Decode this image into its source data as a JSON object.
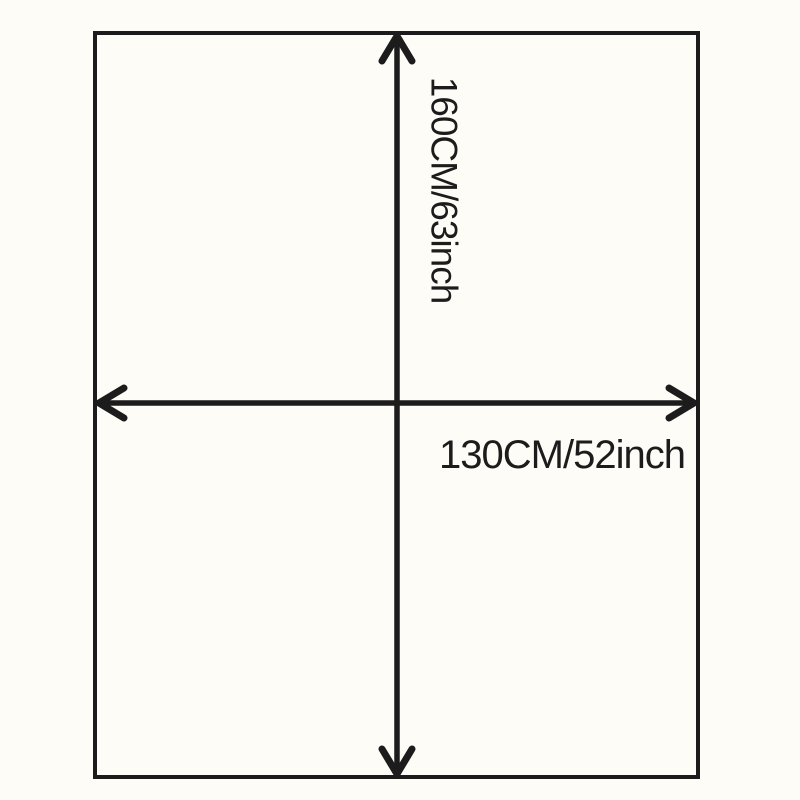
{
  "diagram": {
    "title": "size-dimension-diagram",
    "height_label": "160CM/63inch",
    "width_label": "130CM/52inch",
    "colors": {
      "background": "#fdfcf7",
      "line": "#1c1c1c",
      "text": "#1c1c1c"
    }
  }
}
